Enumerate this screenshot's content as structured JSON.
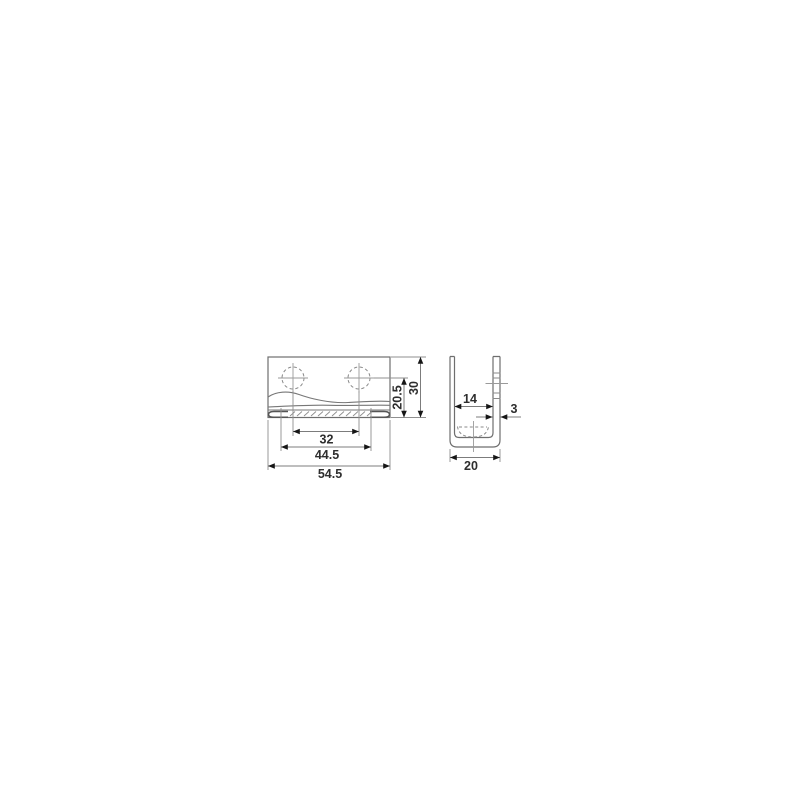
{
  "drawing": {
    "title": "Two-view dimensioned technical drawing of a U-shaped mounting bracket",
    "views": {
      "front": {
        "dims": {
          "hole_spacing": "32",
          "flange_width": "44.5",
          "overall_width": "54.5",
          "hole_height": "20.5",
          "overall_height": "30"
        }
      },
      "side": {
        "dims": {
          "inner_width": "14",
          "wall_thickness": "3",
          "outer_width": "20"
        }
      }
    },
    "colors": {
      "background": "#ffffff",
      "outline": "#6e6e6e",
      "dimension_line": "#7c7c7c",
      "extension_line": "#8f8f8f",
      "arrow": "#161616",
      "text": "#2e2e2e"
    }
  }
}
